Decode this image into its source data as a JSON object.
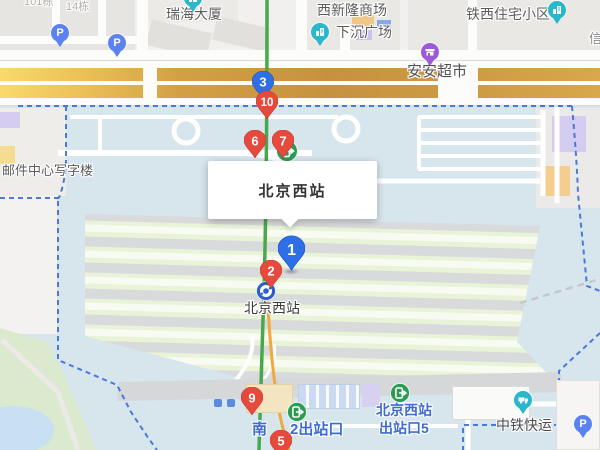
{
  "map": {
    "info_box": {
      "title": "北京西站"
    },
    "markers": [
      {
        "label": "3",
        "color": "blue"
      },
      {
        "label": "10",
        "color": "red"
      },
      {
        "label": "6",
        "color": "red"
      },
      {
        "label": "7",
        "color": "red"
      },
      {
        "label": "1",
        "color": "blue"
      },
      {
        "label": "2",
        "color": "red"
      },
      {
        "label": "9",
        "color": "red"
      },
      {
        "label": "5",
        "color": "red"
      }
    ],
    "labels": {
      "bldg_14": "14栋",
      "bldg_101": "101栋",
      "ruihai_tower": "瑞海大厦",
      "xixinlong_mall": "西新隆商场",
      "sunken_plaza": "下沉广场",
      "tiexi_residential": "铁西住宅小区",
      "xin_partial": "信",
      "anan_supermarket": "安安超市",
      "mail_center_office": "邮件中心写字楼",
      "subway_station": "北京西站",
      "south_exit_prefix": "南",
      "south_exit_suffix": "2出站口",
      "exit5_line1": "北京西站",
      "exit5_line2": "出站口5",
      "china_railway_express": "中铁快运"
    },
    "parking_icon_label": "P",
    "colors": {
      "marker_red": "#E64A3D",
      "marker_blue": "#2E6FE8",
      "boundary_blue": "#3F6FD8",
      "subway_line_green": "#49A84D",
      "rail_line_orange": "#F1A83C",
      "exit_icon_green": "#2C9C55",
      "poi_teal": "#29B7CB",
      "poi_purple": "#9C5BD6",
      "parking_blue": "#5C82F2",
      "exit_label_blue": "#3D6BD0"
    }
  }
}
